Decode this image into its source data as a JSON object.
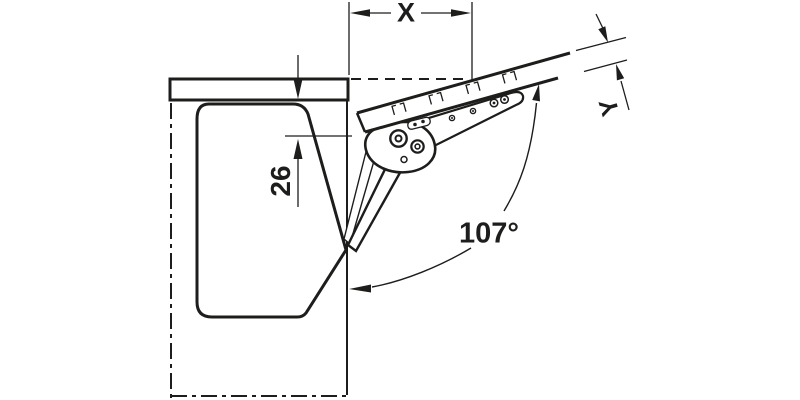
{
  "page": {
    "background_color": "#ffffff",
    "line_color": "#1d1d1b"
  },
  "drawing": {
    "subject": "flap-fitting-side-view",
    "labels": {
      "x_dimension": "X",
      "y_dimension": "Y",
      "distance_26": "26",
      "opening_angle": "107°"
    }
  }
}
